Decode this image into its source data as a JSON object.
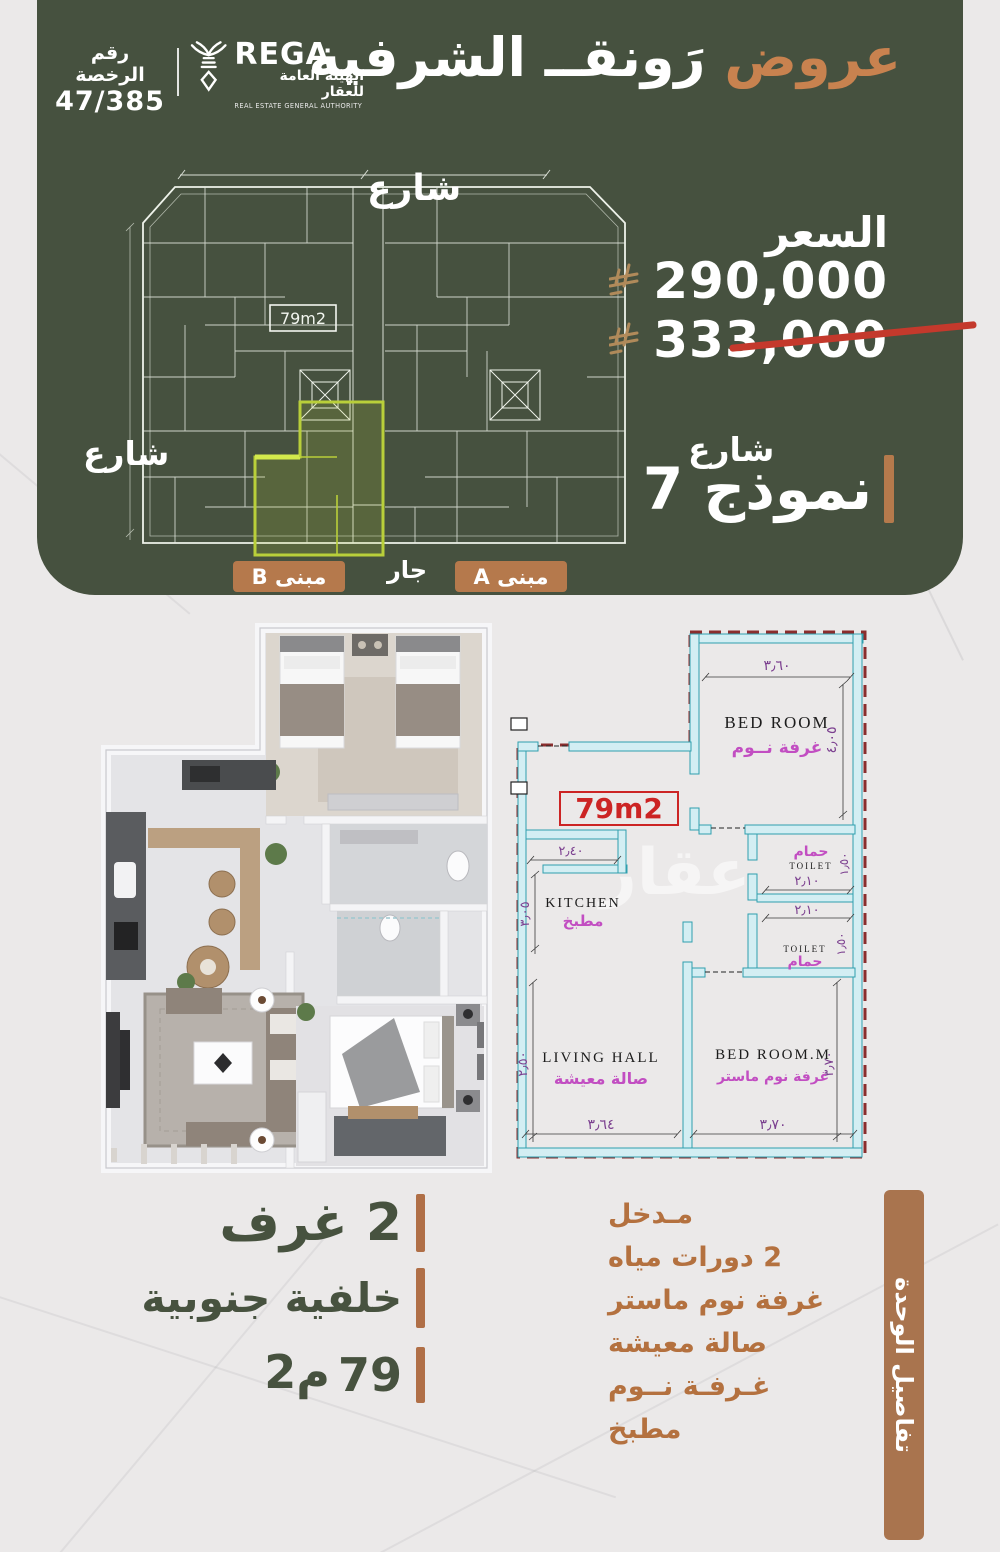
{
  "header": {
    "license_label": "رقم الرخصة",
    "license_number": "47/385",
    "rega_name": "REGA",
    "rega_ar": "الهيئة العامة للعقار",
    "rega_en": "REAL ESTATE GENERAL AUTHORITY",
    "title_accent": "عروض",
    "title_main": "رَونقــ الشرفية"
  },
  "site_plan": {
    "street_top": "شارع",
    "street_left": "شارع",
    "area_badge": "79m2",
    "building_b": "مبنى B",
    "neighbor_label": "جار",
    "building_a": "مبنى A"
  },
  "price": {
    "label": "السعر",
    "current": "290,000",
    "old": "333,000"
  },
  "model": {
    "street_right": "شارع",
    "name": "نموذج 7"
  },
  "unit_plan": {
    "area_badge": "79m2",
    "watermark": "عقار",
    "rooms": {
      "bedroom_en": "BED ROOM",
      "bedroom_ar": "غرفة نــوم",
      "toilet_en": "TOILET",
      "toilet_ar": "حمام",
      "kitchen_en": "KITCHEN",
      "kitchen_ar": "مطبخ",
      "living_en": "LIVING HALL",
      "living_ar": "صالة معيشة",
      "master_en": "BED ROOM.M",
      "master_ar": "غرفة نوم ماستر"
    },
    "dims": {
      "bedroom_top": "٣٫٦٠",
      "bedroom_right": "٤٫٠٥",
      "kitchen_top": "٢٫٤٠",
      "kitchen_left": "٣٫٠٥",
      "toilet1_w": "٢٫١٠",
      "toilet1_h": "١٫٥٠",
      "toilet2_w": "٢٫١٠",
      "toilet2_h": "١٫٥٠",
      "living_left": "٢٫٥٠",
      "living_bottom": "٣٫٦٤",
      "master_bottom": "٣٫٧٠",
      "master_right": "٣٫٧٠"
    }
  },
  "details_left": {
    "rooms": "2 غرف",
    "orientation": "خلفية جنوبية",
    "area_value": "79",
    "area_unit": "م2"
  },
  "details_right": {
    "title": "تفاصيل الوحدة",
    "items": [
      "مـدخل",
      "2 دورات مياه",
      "غرفة نوم ماستر",
      "صالة معيشة",
      "غـرفـة نــوم",
      "مطبخ"
    ]
  }
}
